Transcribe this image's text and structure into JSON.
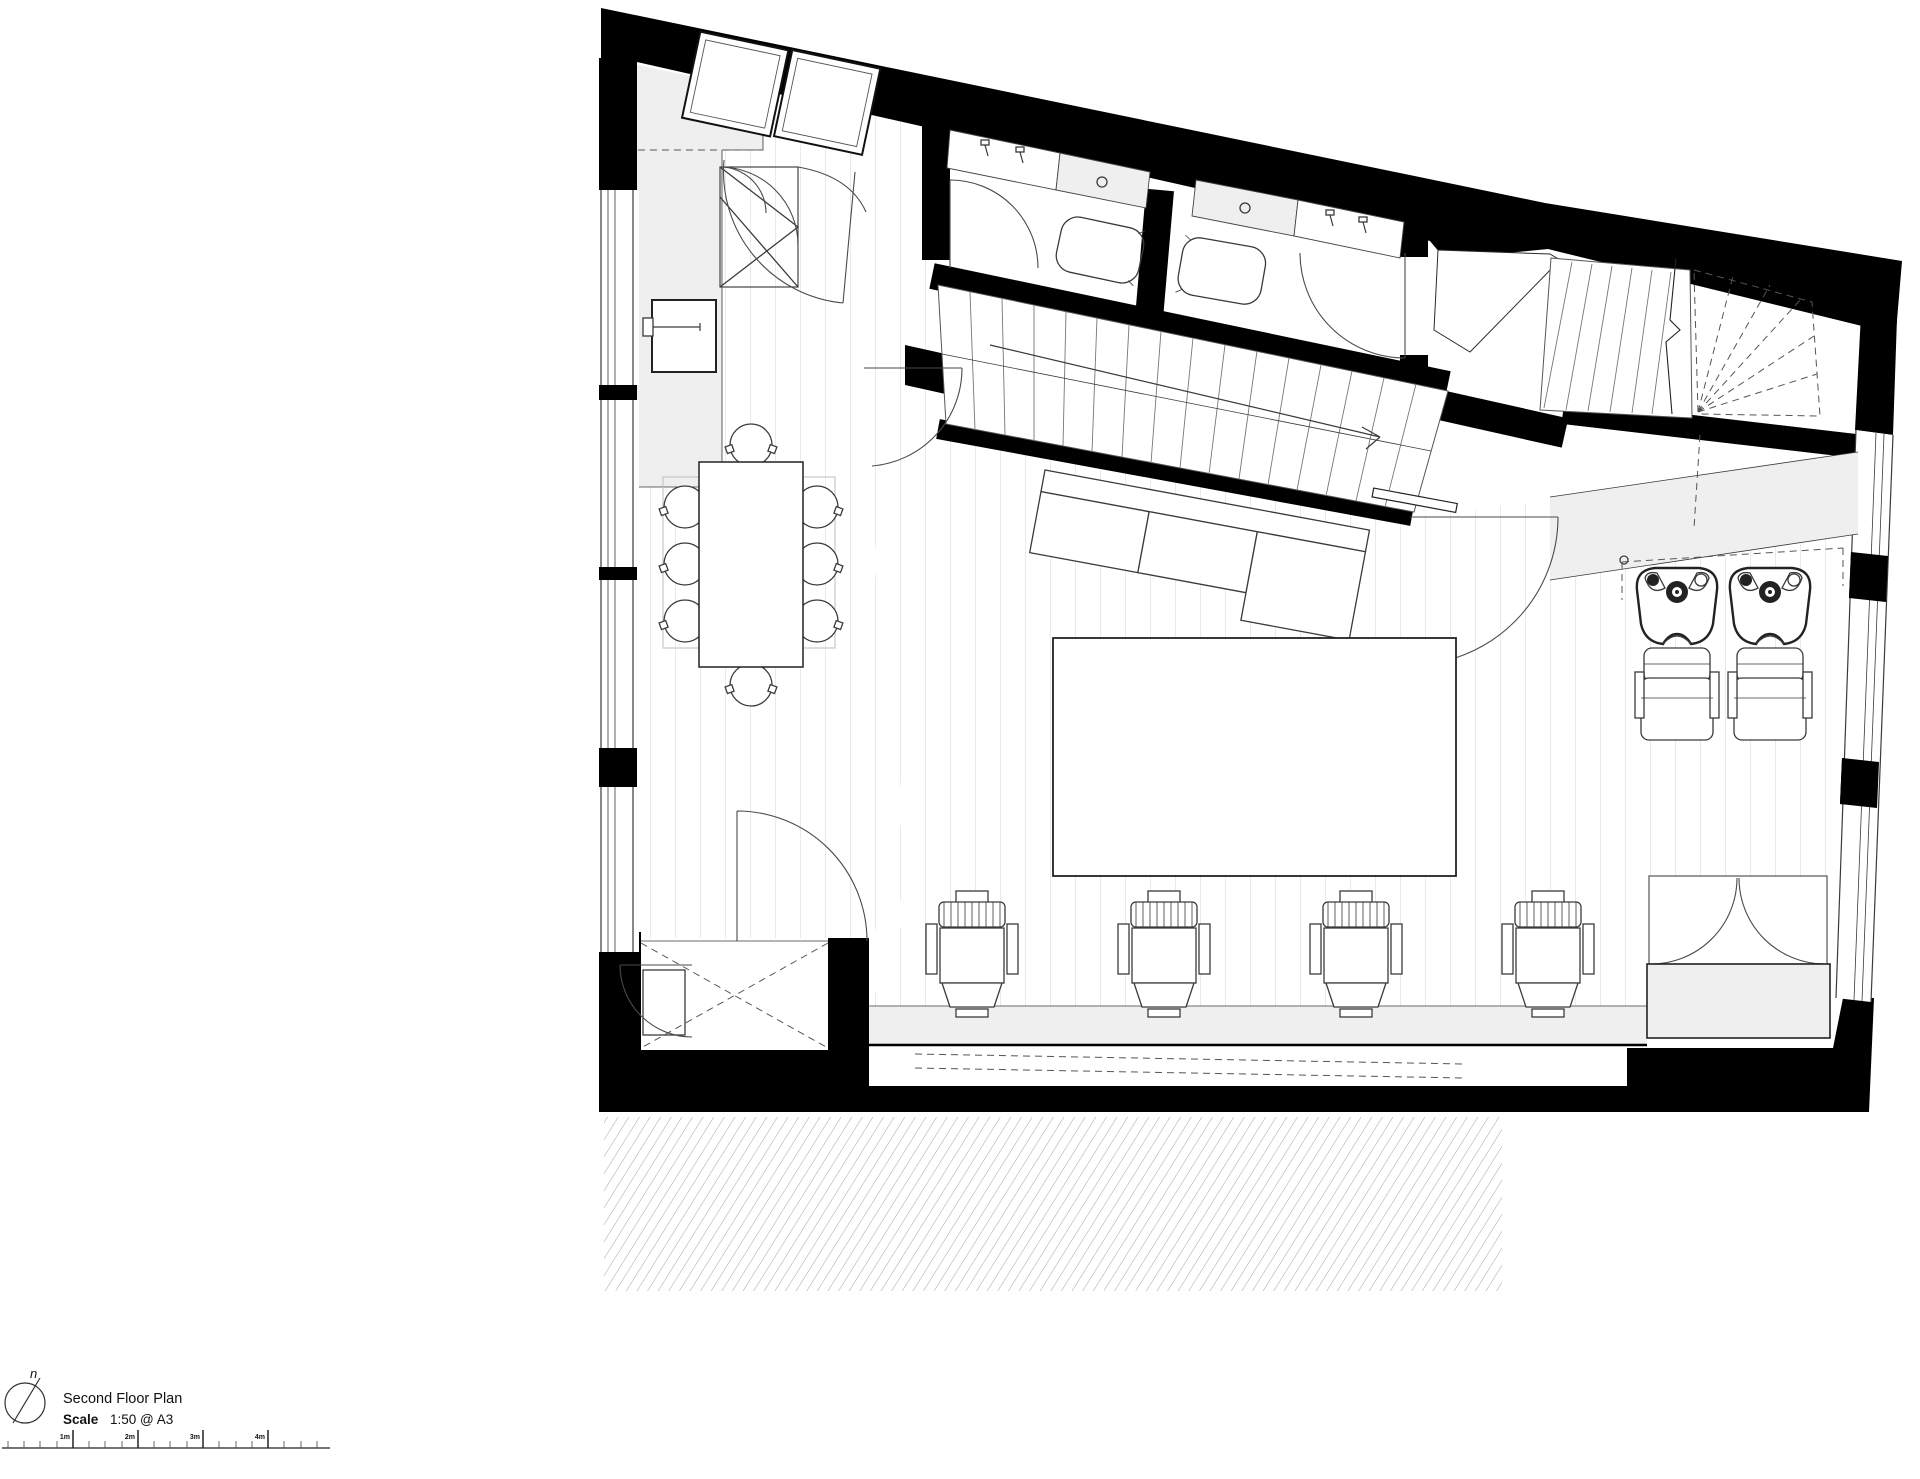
{
  "title_block": {
    "north_label": "n",
    "title": "Second Floor Plan",
    "scale_label": "Scale",
    "scale_value": "1:50 @ A3"
  },
  "scale_bar": {
    "tick_labels": [
      "1m",
      "2m",
      "3m",
      "4m"
    ]
  },
  "colors": {
    "wall": "#000000",
    "line": "#3a3a3a",
    "light_fill": "#efefef",
    "plank_line": "#d6d6d6",
    "hatch_line": "#9a9a9a"
  }
}
